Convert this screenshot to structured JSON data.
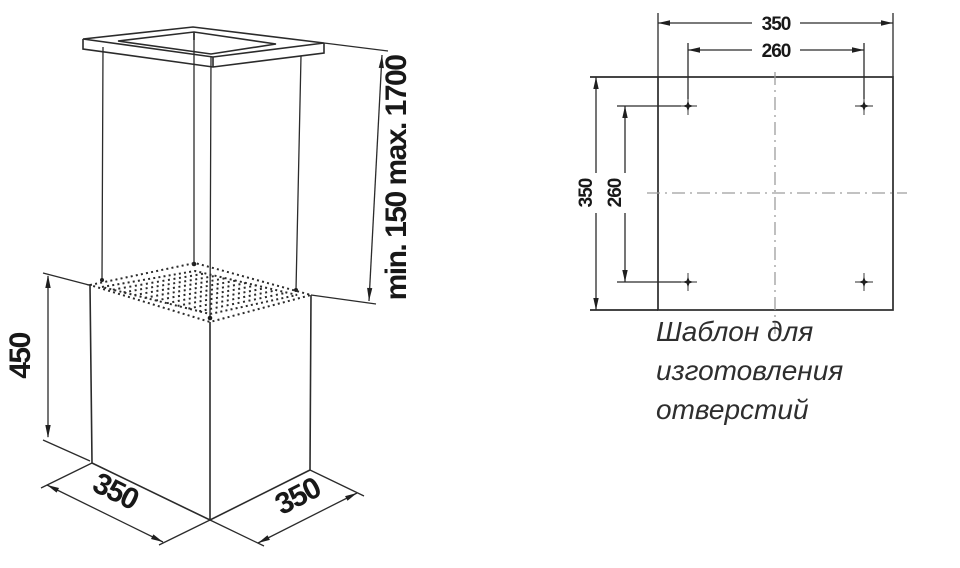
{
  "figure": {
    "suspension_range_label": "min. 150 max. 1700",
    "height_label": "450",
    "width_label": "350",
    "depth_label": "350"
  },
  "template": {
    "width_label": "350",
    "hole_spacing_horizontal_label": "260",
    "height_label": "350",
    "hole_spacing_vertical_label": "260",
    "caption_line1": "Шаблон для",
    "caption_line2": "изготовления",
    "caption_line3": "отверстий"
  },
  "colors": {
    "ink": "#2b2b2b",
    "centerline": "#9d9d9d",
    "caption_text": "#2e2e2e",
    "background": "#ffffff"
  }
}
